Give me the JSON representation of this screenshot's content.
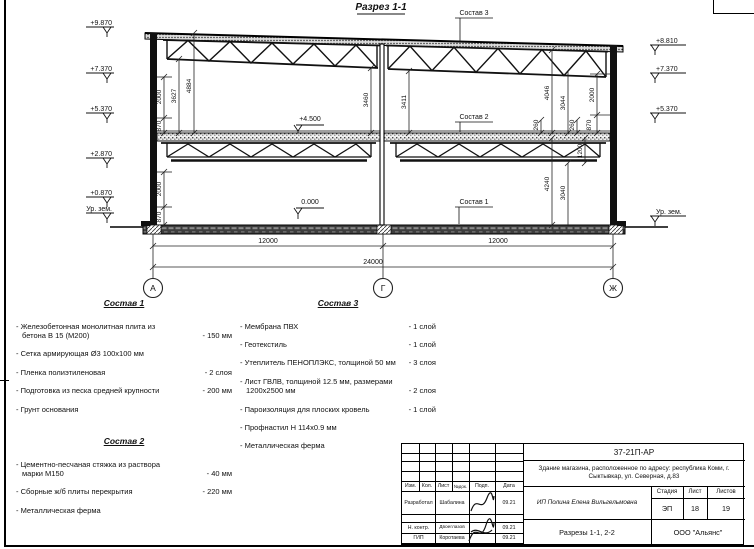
{
  "sheet": {
    "section_title": "Разрез 1-1",
    "axes": [
      "А",
      "Г",
      "Ж"
    ],
    "elev_left": [
      "+9.870",
      "+7.370",
      "+5.370",
      "+2.870",
      "+0.870",
      "Ур. зем."
    ],
    "elev_right": [
      "+8.810",
      "+7.370",
      "+5.370",
      "Ур. зем."
    ],
    "level_mid": "+4.500",
    "level_zero": "0.000",
    "callouts": {
      "c1": "Состав 1",
      "c2": "Состав 2",
      "c3": "Состав 3"
    },
    "dims": {
      "lu2000": "2000",
      "lu870": "870",
      "l3627": "3627",
      "l4884": "4884",
      "ll2000": "2000",
      "ll870": "870",
      "c3460": "3460",
      "c3411": "3411",
      "r260a": "260",
      "r4046": "4046",
      "r3044": "3044",
      "r260b": "260",
      "r2000": "2000",
      "r870": "870",
      "rl4240": "4240",
      "rl3040": "3040",
      "rl1200": "1200",
      "span1": "12000",
      "span2": "12000",
      "total": "24000"
    }
  },
  "compositions": [
    {
      "title": "Состав 1",
      "items": [
        {
          "n": "- Железобетонная  монолитная плита из бетона В 15 (М200)",
          "v": "- 150 мм"
        },
        {
          "n": "- Сетка армирующая Ø3 100x100 мм",
          "v": ""
        },
        {
          "n": "- Пленка полиэтиленовая",
          "v": "- 2 слоя"
        },
        {
          "n": "- Подготовка из песка средней крупности",
          "v": "- 200 мм"
        },
        {
          "n": "- Грунт основания",
          "v": ""
        }
      ]
    },
    {
      "title": "Состав 2",
      "items": [
        {
          "n": "- Цементно-песчаная стяжка из раствора марки М150",
          "v": "- 40 мм"
        },
        {
          "n": "- Сборные ж/б плиты перекрытия",
          "v": "- 220 мм"
        },
        {
          "n": "- Металлическая ферма",
          "v": ""
        }
      ]
    },
    {
      "title": "Состав 3",
      "items": [
        {
          "n": "- Мембрана ПВХ",
          "v": "- 1 слой"
        },
        {
          "n": "- Геотекстиль",
          "v": "- 1 слой"
        },
        {
          "n": "- Утеплитель ПЕНОПЛЭКС, толщиной 50 мм",
          "v": "- 3 слоя"
        },
        {
          "n": "- Лист ГВЛВ, толщиной 12.5 мм, размерами 1200x2500 мм",
          "v": "- 2 слоя"
        },
        {
          "n": "- Пароизоляция для плоских кровель",
          "v": "- 1 слой"
        },
        {
          "n": "- Профнастил Н 114x0.9 мм",
          "v": ""
        },
        {
          "n": "- Металлическая ферма",
          "v": ""
        }
      ]
    }
  ],
  "titleblock": {
    "doc_number": "37-21П-АР",
    "object_text": "Здание магазина, расположенное по адресу: республика Коми, г. Сыктывкар, ул. Северная, д.83",
    "cols": [
      "Изм.",
      "Кол.",
      "Лист",
      "№док.",
      "Подп.",
      "Дата"
    ],
    "sign_rows": [
      {
        "role": "Разработал",
        "name": "Шабалина",
        "date": "09.21"
      },
      {
        "role": "Н. контр.",
        "name": "Двоеглазов",
        "date": "09.21"
      },
      {
        "role": "ГИП",
        "name": "Коротаева",
        "date": "09.21"
      }
    ],
    "designer": "ИП Полина Елена Вильгельмовна",
    "stage_label": "Стадия",
    "sheet_label": "Лист",
    "sheets_label": "Листов",
    "stage": "ЭП",
    "sheet_no": "18",
    "sheets_total": "19",
    "sheet_title": "Разрезы 1-1, 2-2",
    "company": "ООО \"Альянс\""
  }
}
